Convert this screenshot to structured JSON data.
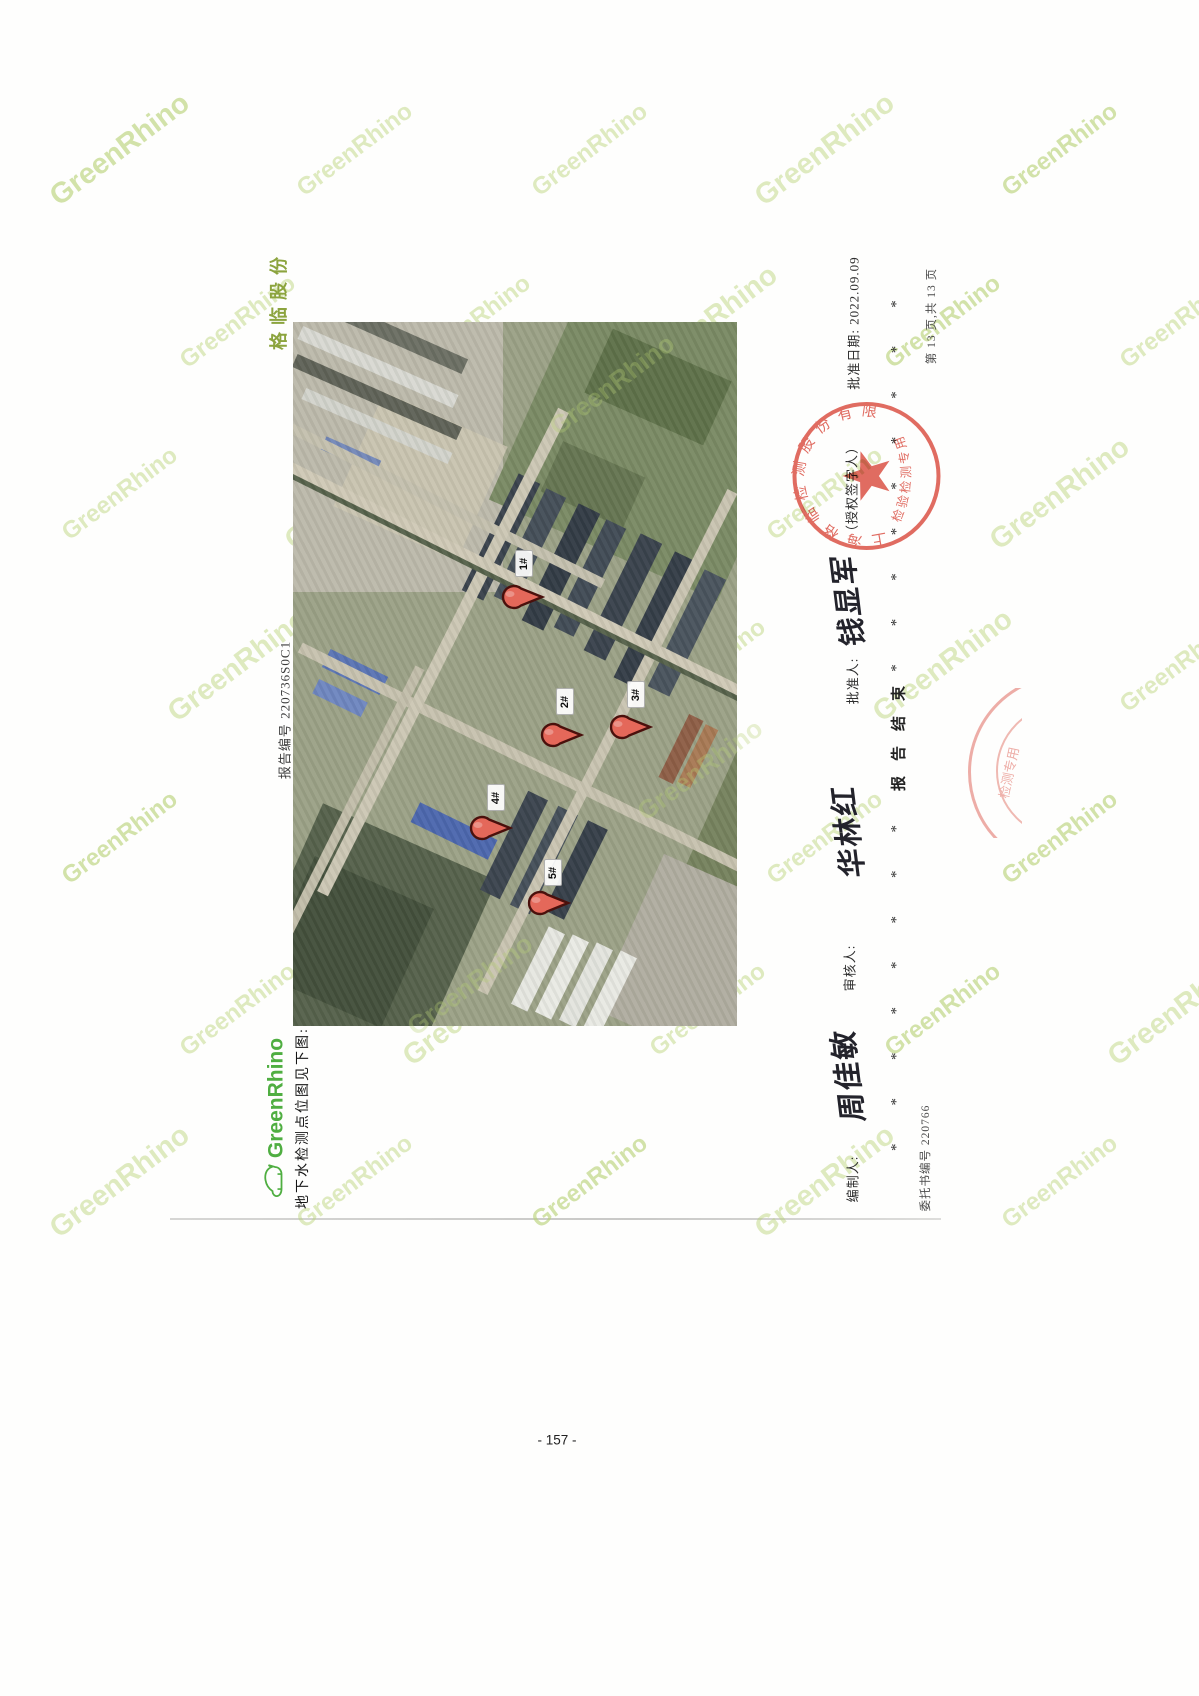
{
  "page": {
    "brand_vertical": "格临股份",
    "report_no": "报告编号 220736S0C1",
    "logo_text": "GreenRhino",
    "map_caption": "地下水检测点位图见下图:",
    "watermark_text": "GreenRhino",
    "page_number": "- 157 -"
  },
  "map": {
    "markers": [
      {
        "label": "1#"
      },
      {
        "label": "2#"
      },
      {
        "label": "3#"
      },
      {
        "label": "4#"
      },
      {
        "label": "5#"
      }
    ],
    "pin_color": "#e4685a"
  },
  "footer": {
    "approval_date": "批准日期: 2022.09.09",
    "authorized_note": "（授权签字人）",
    "approved_label": "批准人:",
    "approved_signature": "钱显军",
    "reviewed_label": "审核人:",
    "reviewed_signature": "华林红",
    "prepared_label": "编制人:",
    "prepared_signature": "周佳敏",
    "report_end": "报告结束",
    "asterisks_top": "*********",
    "asterisks_bottom": "********",
    "page_info": "第 13 页,共 13 页",
    "commission_no": "委托书编号 220766"
  },
  "stamp": {
    "company": "上海格临检测股份有限公司",
    "title": "检验检测专用章",
    "edge_fragment": "检测专用",
    "color": "#dc5348"
  }
}
